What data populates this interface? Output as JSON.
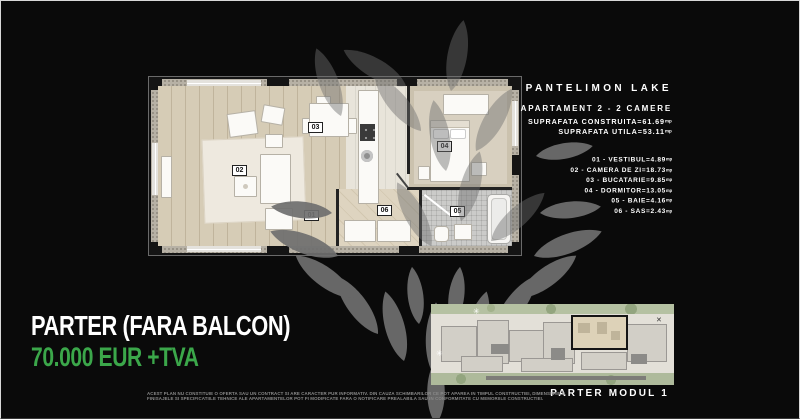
{
  "header": {
    "title": "PANTELIMON LAKE",
    "subtitle": "APARTAMENT 2 - 2 CAMERE",
    "areas": [
      {
        "label": "SUPRAFATA CONSTRUITA",
        "value": "=61.69",
        "unit": "mp"
      },
      {
        "label": "SUPRAFATA UTILA",
        "value": "=53.11",
        "unit": "mp"
      }
    ]
  },
  "rooms": [
    {
      "id": "01",
      "name": "VESTIBUL",
      "area": "4.89",
      "unit": "mp"
    },
    {
      "id": "02",
      "name": "CAMERA DE ZI",
      "area": "18.73",
      "unit": "mp"
    },
    {
      "id": "03",
      "name": "BUCATARIE",
      "area": "9.85",
      "unit": "mp"
    },
    {
      "id": "04",
      "name": "DORMITOR",
      "area": "13.05",
      "unit": "mp"
    },
    {
      "id": "05",
      "name": "BAIE",
      "area": "4.16",
      "unit": "mp"
    },
    {
      "id": "06",
      "name": "SAS",
      "area": "2.43",
      "unit": "mp"
    }
  ],
  "offer": {
    "floor_line": "PARTER (FARA BALCON)",
    "price_line": "70.000 EUR +TVA"
  },
  "thumbnail": {
    "caption": "PARTER MODUL 1"
  },
  "disclaimer": "ACEST PLAN NU CONSTITUIE O OFERTA SAU UN CONTRACT SI ARE CARACTER PUR INFORMATIV. DIN CAUZA SCHIMBARILOR CE POT APAREA IN TIMPUL CONSTRUCTIEI, DIMENSIUNILE, FINISAJELE SI SPECIFICATIILE TEHNICE ALE APARTAMENTELOR POT FI MODIFICATE FARA O NOTIFICARE PREALABILA SAU IN CONFORMITATE CU MEMORIILE CONSTRUCTIEI.",
  "colors": {
    "accent_green": "#3BA74A",
    "background": "#0A0A0A",
    "watermark_gray": "#6F6F6F"
  }
}
